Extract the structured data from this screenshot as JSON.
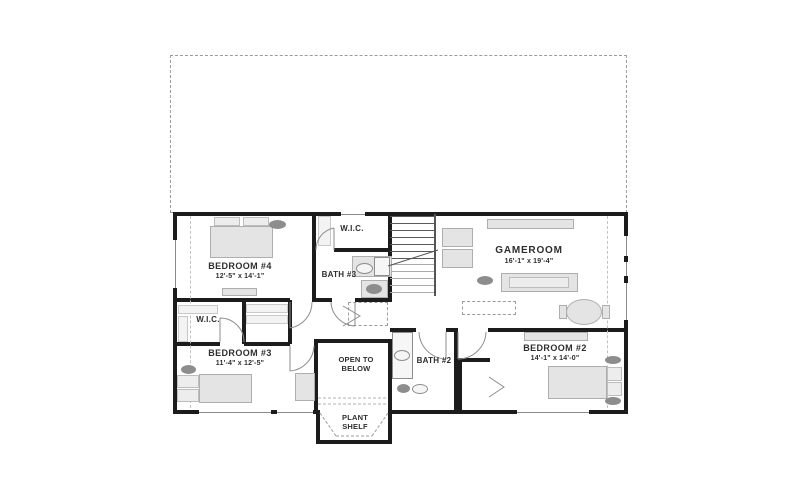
{
  "colors": {
    "background": "#ffffff",
    "wall": "#1c1c1c",
    "furniture_fill": "#e4e4e4",
    "furniture_stroke": "#aeaeae",
    "accent_dark": "#8d8d8d",
    "dashed_line": "#9b9b9b",
    "text": "#2e2e2e"
  },
  "rooms": {
    "bedroom4": {
      "label": "BEDROOM #4",
      "dims": "12'-5\" x 14'-1\""
    },
    "wic_top": {
      "label": "W.I.C."
    },
    "bath3": {
      "label": "BATH #3"
    },
    "gameroom": {
      "label": "GAMEROOM",
      "dims": "16'-1\" x 19'-4\""
    },
    "wic_left": {
      "label": "W.I.C."
    },
    "bedroom3": {
      "label": "BEDROOM #3",
      "dims": "11'-4\" x 12'-5\""
    },
    "open_to_below": {
      "label": "OPEN TO BELOW"
    },
    "bath2": {
      "label": "BATH #2"
    },
    "bedroom2": {
      "label": "BEDROOM #2",
      "dims": "14'-1\" x 14'-0\""
    },
    "plant_shelf": {
      "label": "PLANT SHELF"
    }
  }
}
